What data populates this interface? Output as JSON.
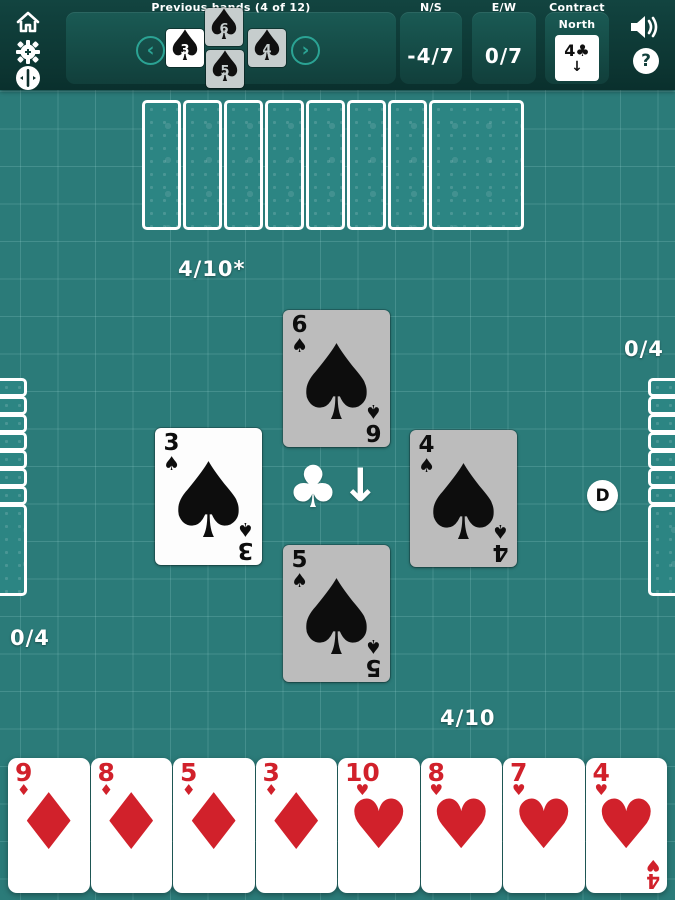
{
  "colors": {
    "field": "#2b7b79",
    "bar": "#0d3835",
    "panel": "#175450",
    "accent_teal": "#2ba394",
    "card_gray": "#bcbcbc",
    "card_white": "#fdfdfd",
    "red_suit": "#d1212b",
    "black_suit": "#0d0d0d"
  },
  "glyphs": {
    "spade": "♠",
    "heart": "♥",
    "diamond": "♦",
    "club": "♣",
    "down_arrow": "↓",
    "chevron_left": "‹",
    "chevron_right": "›",
    "question": "?"
  },
  "topbar": {
    "previous_hands_label": "Previous hands (4 of 12)",
    "mini_trick": [
      {
        "seat": "top",
        "rank": "6",
        "suit": "spade",
        "bg": "gray"
      },
      {
        "seat": "left",
        "rank": "3",
        "suit": "spade",
        "bg": "white"
      },
      {
        "seat": "right",
        "rank": "4",
        "suit": "spade",
        "bg": "gray"
      },
      {
        "seat": "bottom",
        "rank": "5",
        "suit": "spade",
        "bg": "gray"
      }
    ],
    "ns": {
      "label": "N/S",
      "value": "-4/7"
    },
    "ew": {
      "label": "E/W",
      "value": "0/7"
    },
    "contract": {
      "label": "Contract",
      "player": "North",
      "bid_rank": "4",
      "bid_suit": "club",
      "direction": "down"
    }
  },
  "table": {
    "scores": {
      "north": "4/10*",
      "south": "4/10",
      "west": "0/4",
      "east": "0/4"
    },
    "dealer_badge": "D",
    "center_suit": "club",
    "center_direction": "down",
    "trick": [
      {
        "seat": "north",
        "rank": "6",
        "suit": "spade",
        "bg": "gray"
      },
      {
        "seat": "west",
        "rank": "3",
        "suit": "spade",
        "bg": "white"
      },
      {
        "seat": "east",
        "rank": "4",
        "suit": "spade",
        "bg": "gray"
      },
      {
        "seat": "south",
        "rank": "5",
        "suit": "spade",
        "bg": "gray"
      }
    ],
    "hidden_hands": {
      "north": 8,
      "west": 8,
      "east": 8
    }
  },
  "south_hand": [
    {
      "rank": "9",
      "suit": "diamond"
    },
    {
      "rank": "8",
      "suit": "diamond"
    },
    {
      "rank": "5",
      "suit": "diamond"
    },
    {
      "rank": "3",
      "suit": "diamond"
    },
    {
      "rank": "10",
      "suit": "heart"
    },
    {
      "rank": "8",
      "suit": "heart"
    },
    {
      "rank": "7",
      "suit": "heart"
    },
    {
      "rank": "4",
      "suit": "heart"
    }
  ]
}
